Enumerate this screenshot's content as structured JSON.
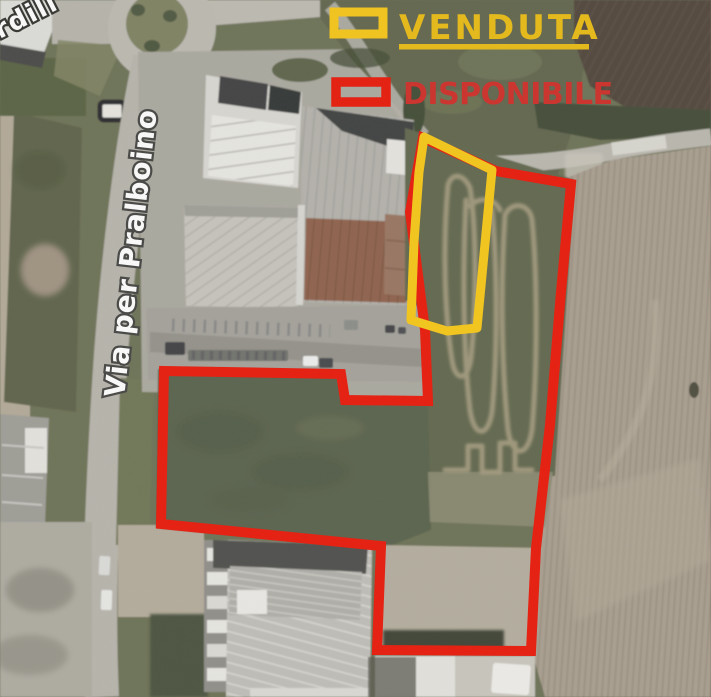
{
  "map": {
    "road_label": "Via per Pralboino",
    "corner_label_fragment": "ordili",
    "type_hint": "satellite-aerial-view"
  },
  "legend": {
    "venduta": {
      "label": "VENDUTA",
      "color": "#E9BA10"
    },
    "disponibile": {
      "label": "DISPONIBILE",
      "color": "#CE2A24"
    }
  },
  "parcels": {
    "sold_outline_color": "#F7C713",
    "available_outline_color": "#EA1506"
  }
}
